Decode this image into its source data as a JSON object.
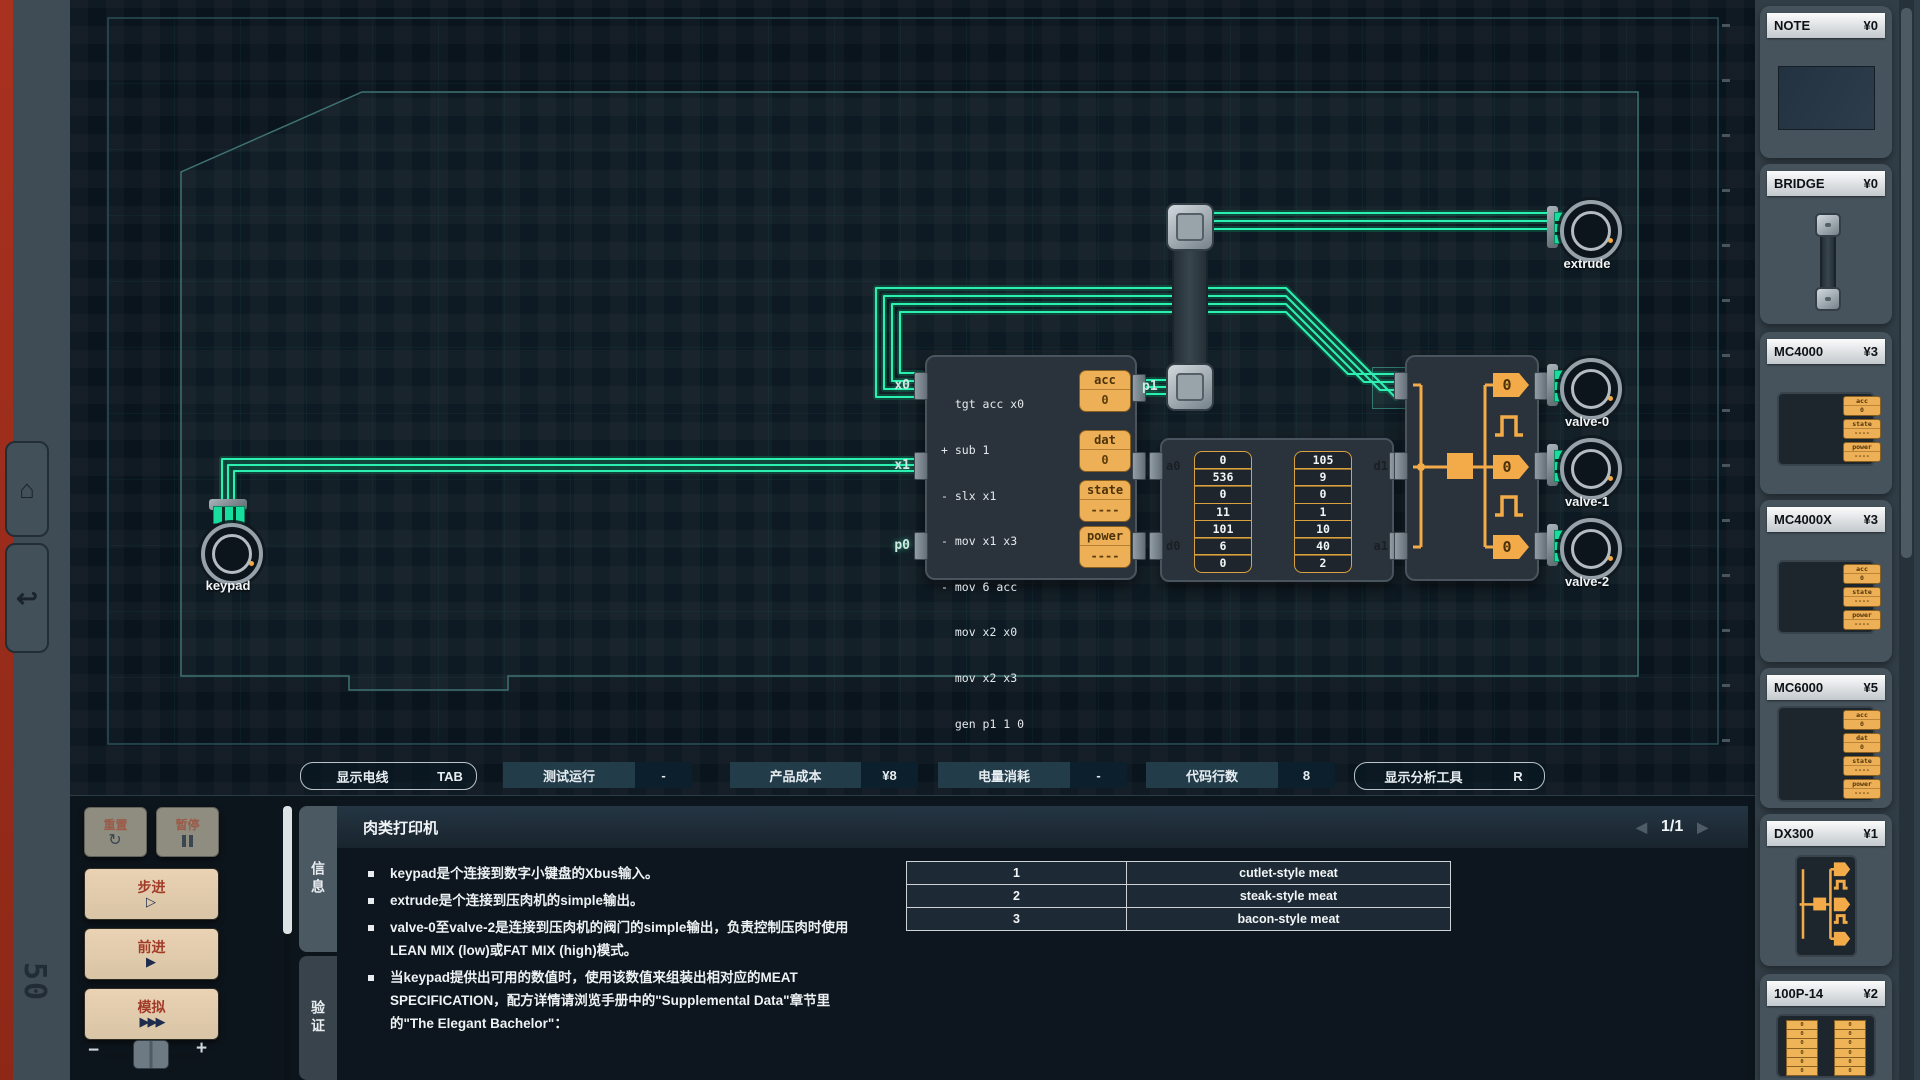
{
  "app": {
    "logo_text": "50"
  },
  "icons": {
    "home": "⌂",
    "undo": "↩",
    "reset": "↻",
    "step": "▷",
    "advance": "▶",
    "simulate": "▶▶▶",
    "slider_minus": "−",
    "slider_plus": "+",
    "page_prev": "◀",
    "page_next": "▶"
  },
  "board": {
    "connectors": [
      {
        "label": "keypad"
      },
      {
        "label": "extrude"
      },
      {
        "label": "valve-0"
      },
      {
        "label": "valve-1"
      },
      {
        "label": "valve-2"
      }
    ],
    "chip": {
      "code_lines": [
        "  tgt acc x0",
        "+ sub 1",
        "- slx x1",
        "- mov x1 x3",
        "- mov 6 acc",
        "  mov x2 x0",
        "  mov x2 x3",
        "  gen p1 1 0"
      ],
      "registers": [
        {
          "name": "acc",
          "value": "0"
        },
        {
          "name": "dat",
          "value": "0"
        },
        {
          "name": "state",
          "value": "----"
        },
        {
          "name": "power",
          "value": "----"
        }
      ],
      "ports": {
        "x0": "x0",
        "x1": "x1",
        "p0": "p0",
        "p1": "p1"
      }
    },
    "ram": {
      "ports": {
        "a0": "a0",
        "d0": "d0",
        "d1": "d1",
        "a1": "a1"
      },
      "left_column": [
        "0",
        "536",
        "0",
        "11",
        "101",
        "6",
        "0"
      ],
      "right_column": [
        "105",
        "9",
        "0",
        "1",
        "10",
        "40",
        "2"
      ]
    },
    "dx300": {
      "output_glyph": "0"
    }
  },
  "status_bar": {
    "items": [
      {
        "label": "显示电线",
        "value": "TAB"
      },
      {
        "label": "测试运行",
        "value": "-"
      },
      {
        "label": "产品成本",
        "value": "¥8"
      },
      {
        "label": "电量消耗",
        "value": "-"
      },
      {
        "label": "代码行数",
        "value": "8"
      },
      {
        "label": "显示分析工具",
        "value": "R"
      }
    ]
  },
  "controls": {
    "reset": "重置",
    "pause": "暂停",
    "step": "步进",
    "advance": "前进",
    "simulate": "模拟"
  },
  "side_tabs": {
    "info": "信息",
    "verify": "验证"
  },
  "info_panel": {
    "title": "肉类打印机",
    "pager": "1/1",
    "bullets": [
      "keypad是个连接到数字小键盘的Xbus输入。",
      "extrude是个连接到压肉机的simple输出。",
      "valve-0至valve-2是连接到压肉机的阀门的simple输出，负责控制压肉时使用LEAN MIX (low)或FAT MIX (high)模式。",
      "当keypad提供出可用的数值时，使用该数值来组装出相对应的MEAT SPECIFICATION，配方详情请浏览手册中的\"Supplemental Data\"章节里的\"The Elegant Bachelor\"："
    ],
    "table_rows": [
      {
        "key": "1",
        "value": "cutlet-style meat"
      },
      {
        "key": "2",
        "value": "steak-style meat"
      },
      {
        "key": "3",
        "value": "bacon-style meat"
      }
    ]
  },
  "parts_panel": {
    "ram_cell": "0",
    "items": [
      {
        "name": "NOTE",
        "price": "¥0"
      },
      {
        "name": "BRIDGE",
        "price": "¥0"
      },
      {
        "name": "MC4000",
        "price": "¥3",
        "regs": [
          {
            "n": "acc",
            "v": "0"
          },
          {
            "n": "state",
            "v": "----"
          },
          {
            "n": "power",
            "v": "----"
          }
        ]
      },
      {
        "name": "MC4000X",
        "price": "¥3",
        "regs": [
          {
            "n": "acc",
            "v": "0"
          },
          {
            "n": "state",
            "v": "----"
          },
          {
            "n": "power",
            "v": "----"
          }
        ]
      },
      {
        "name": "MC6000",
        "price": "¥5",
        "regs": [
          {
            "n": "acc",
            "v": "0"
          },
          {
            "n": "dat",
            "v": "0"
          },
          {
            "n": "state",
            "v": "----"
          },
          {
            "n": "power",
            "v": "----"
          }
        ]
      },
      {
        "name": "DX300",
        "price": "¥1"
      },
      {
        "name": "100P-14",
        "price": "¥2"
      }
    ]
  },
  "colors": {
    "trace_green": "#2bf0b0",
    "amber": "#f0ab4f",
    "red_stripe": "#a93120"
  }
}
